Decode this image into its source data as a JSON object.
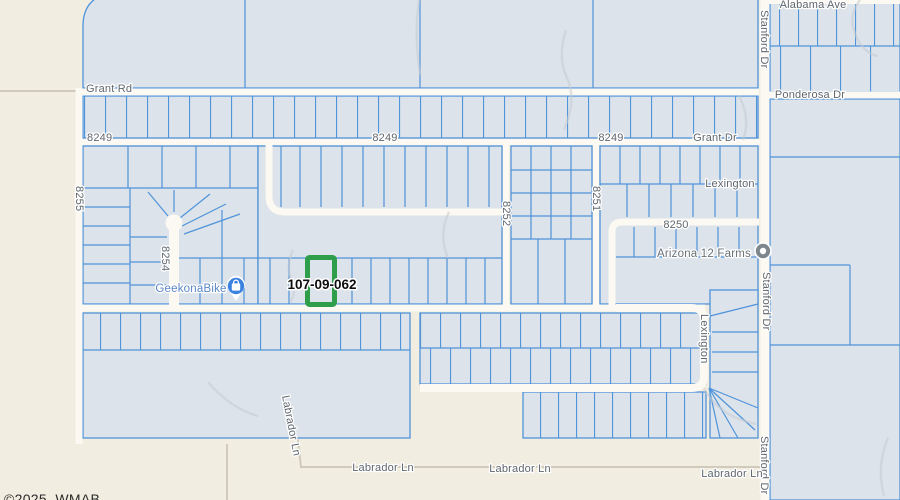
{
  "map": {
    "highlighted_parcel": {
      "id": "107-09-062",
      "outline_color": "#2f9e4b"
    },
    "highlight_label": {
      "text": "107-09-062"
    },
    "copyright": "©2025, WMAB",
    "colors": {
      "land": "#f1ede0",
      "parcel_fill": "#dce3ea",
      "parcel_line": "#4f93da",
      "road": "#fbf9f1",
      "label_gray": "#5f666d",
      "poi_label_blue": "#5a86c6",
      "highlight_green": "#2f9e4b"
    },
    "labels": [
      {
        "id": "grant-rd",
        "text": "Grant Rd",
        "x": 86,
        "y": 92
      },
      {
        "id": "alabama-ave",
        "text": "Alabama Ave",
        "x": 813,
        "y": 8,
        "anchor": "middle"
      },
      {
        "id": "stanford-dr-top",
        "text": "Stanford Dr",
        "x": 761,
        "y": 10,
        "rot": 90
      },
      {
        "id": "ponderosa-dr",
        "text": "Ponderosa Dr",
        "x": 810,
        "y": 98,
        "anchor": "middle"
      },
      {
        "id": "road-8249-west",
        "text": "8249",
        "x": 87,
        "y": 141
      },
      {
        "id": "road-8249-center",
        "text": "8249",
        "x": 385,
        "y": 141,
        "anchor": "middle"
      },
      {
        "id": "road-8249-east",
        "text": "8249",
        "x": 611,
        "y": 141,
        "anchor": "middle"
      },
      {
        "id": "grant-dr",
        "text": "Grant Dr",
        "x": 715,
        "y": 141,
        "anchor": "middle"
      },
      {
        "id": "lexington-upper",
        "text": "Lexington",
        "x": 730,
        "y": 187,
        "anchor": "middle"
      },
      {
        "id": "road-8255",
        "text": "8255",
        "x": 76,
        "y": 186,
        "rot": 90
      },
      {
        "id": "road-8250",
        "text": "8250",
        "x": 676,
        "y": 228,
        "anchor": "middle"
      },
      {
        "id": "road-8252",
        "text": "8252",
        "x": 503,
        "y": 201,
        "rot": 90
      },
      {
        "id": "road-8251",
        "text": "8251",
        "x": 593,
        "y": 186,
        "rot": 90
      },
      {
        "id": "road-8254",
        "text": "8254",
        "x": 162,
        "y": 246,
        "rot": 90
      },
      {
        "id": "stanford-dr-mid",
        "text": "Stanford Dr",
        "x": 763,
        "y": 272,
        "rot": 90
      },
      {
        "id": "lexington-loop",
        "text": "Lexington",
        "x": 701,
        "y": 314,
        "rot": 90
      },
      {
        "id": "labrador-ln-diagonal",
        "text": "Labrador Ln",
        "x": 282,
        "y": 396,
        "rot": 79
      },
      {
        "id": "stanford-dr-bottom",
        "text": "Stanford Dr",
        "x": 761,
        "y": 436,
        "rot": 90
      },
      {
        "id": "labrador-ln-west",
        "text": "Labrador Ln",
        "x": 383,
        "y": 471,
        "anchor": "middle"
      },
      {
        "id": "labrador-ln-center",
        "text": "Labrador Ln",
        "x": 520,
        "y": 472,
        "anchor": "middle"
      },
      {
        "id": "labrador-ln-east",
        "text": "Labrador Ln",
        "x": 732,
        "y": 477,
        "anchor": "middle"
      }
    ],
    "pois": [
      {
        "id": "geekonabike",
        "name": "GeekonaBike",
        "label_x": 191,
        "label_y": 292,
        "style": "poi-blue",
        "icon": "shopping-bag-pin-icon"
      },
      {
        "id": "arizona-12-farms",
        "name": "Arizona 12 Farms",
        "label_x": 704,
        "label_y": 257,
        "style": "poi-gray",
        "icon": "poi-dot-icon"
      }
    ]
  }
}
